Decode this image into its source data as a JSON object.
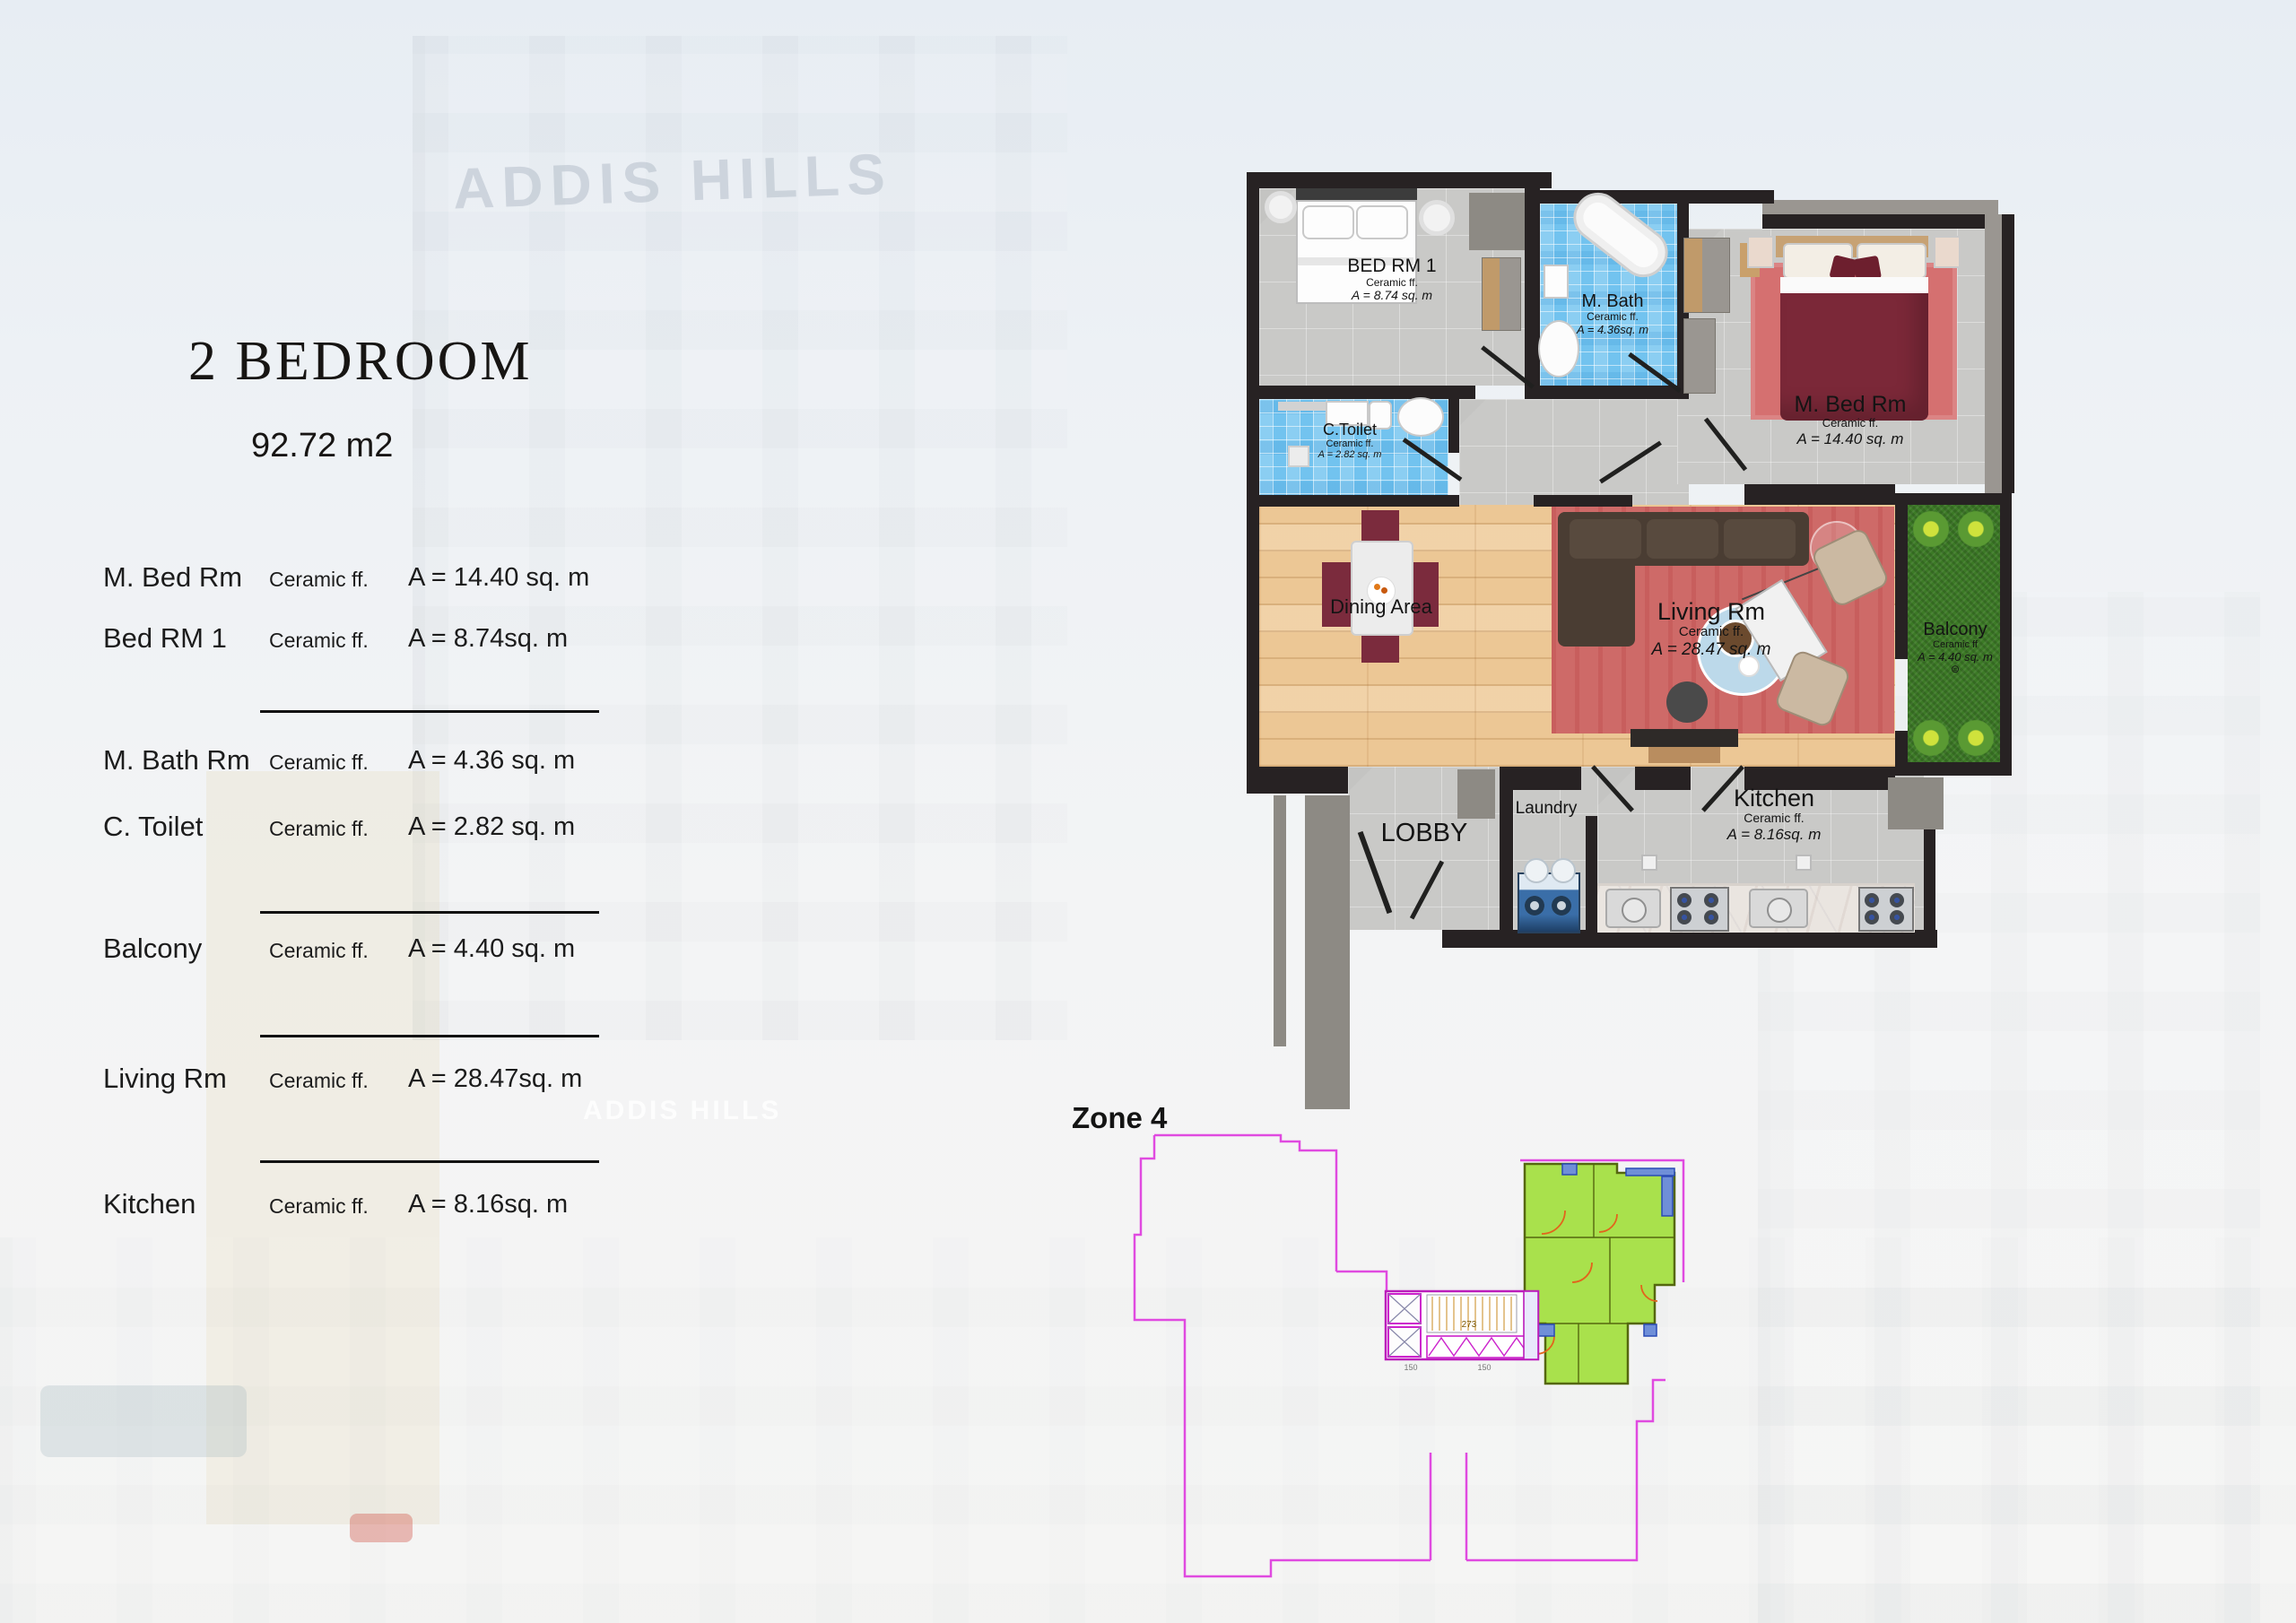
{
  "watermark": "ADDIS HILLS",
  "left_panel": {
    "title": "2 BEDROOM",
    "subtitle": "92.72 m2",
    "rows": [
      {
        "name": "M. Bed Rm",
        "finish": "Ceramic ff.",
        "area": "A = 14.40 sq. m"
      },
      {
        "name": "Bed RM 1",
        "finish": "Ceramic ff.",
        "area": "A = 8.74sq. m"
      },
      {
        "name": "M. Bath Rm",
        "finish": "Ceramic ff.",
        "area": "A = 4.36 sq. m"
      },
      {
        "name": "C. Toilet",
        "finish": "Ceramic ff.",
        "area": "A = 2.82 sq. m"
      },
      {
        "name": "Balcony",
        "finish": "Ceramic ff.",
        "area": "A = 4.40 sq. m"
      },
      {
        "name": "Living Rm",
        "finish": "Ceramic ff.",
        "area": "A = 28.47sq. m"
      },
      {
        "name": "Kitchen",
        "finish": "Ceramic ff.",
        "area": "A = 8.16sq. m"
      }
    ]
  },
  "floor_plan": {
    "rooms": {
      "bed_rm_1": {
        "name": "BED RM 1",
        "finish": "Ceramic ff.",
        "area": "A = 8.74 sq. m"
      },
      "m_bath": {
        "name": "M. Bath",
        "finish": "Ceramic ff.",
        "area": "A = 4.36sq. m"
      },
      "c_toilet": {
        "name": "C.Toilet",
        "finish": "Ceramic ff.",
        "area": "A = 2.82 sq. m"
      },
      "m_bed_rm": {
        "name": "M. Bed Rm",
        "finish": "Ceramic ff.",
        "area": "A = 14.40 sq. m"
      },
      "dining": {
        "name": "Dining Area"
      },
      "living": {
        "name": "Living Rm",
        "finish": "Ceramic ff.",
        "area": "A = 28.47 sq. m"
      },
      "balcony": {
        "name": "Balcony",
        "finish": "Ceramic ff",
        "area": "A = 4.40 sq. m"
      },
      "lobby": {
        "name": "LOBBY"
      },
      "laundry": {
        "name": "Laundry"
      },
      "kitchen": {
        "name": "Kitchen",
        "finish": "Ceramic ff.",
        "area": "A = 8.16sq. m"
      }
    }
  },
  "zone": {
    "label": "Zone 4",
    "dims": [
      "273",
      "150",
      "150"
    ]
  },
  "colors": {
    "wall": "#272223",
    "blue_tile": "#72c3ef",
    "wood": "#ecc795",
    "rug_red": "#d57070",
    "bed_maroon": "#7b2838",
    "grass": "#3c7a26",
    "zone_outline": "#e04ae0",
    "zone_unit_fill": "#a9e14c",
    "zone_unit_stroke": "#55670f",
    "zone_door": "#e2641c",
    "zone_core": "#bb1cbb"
  }
}
